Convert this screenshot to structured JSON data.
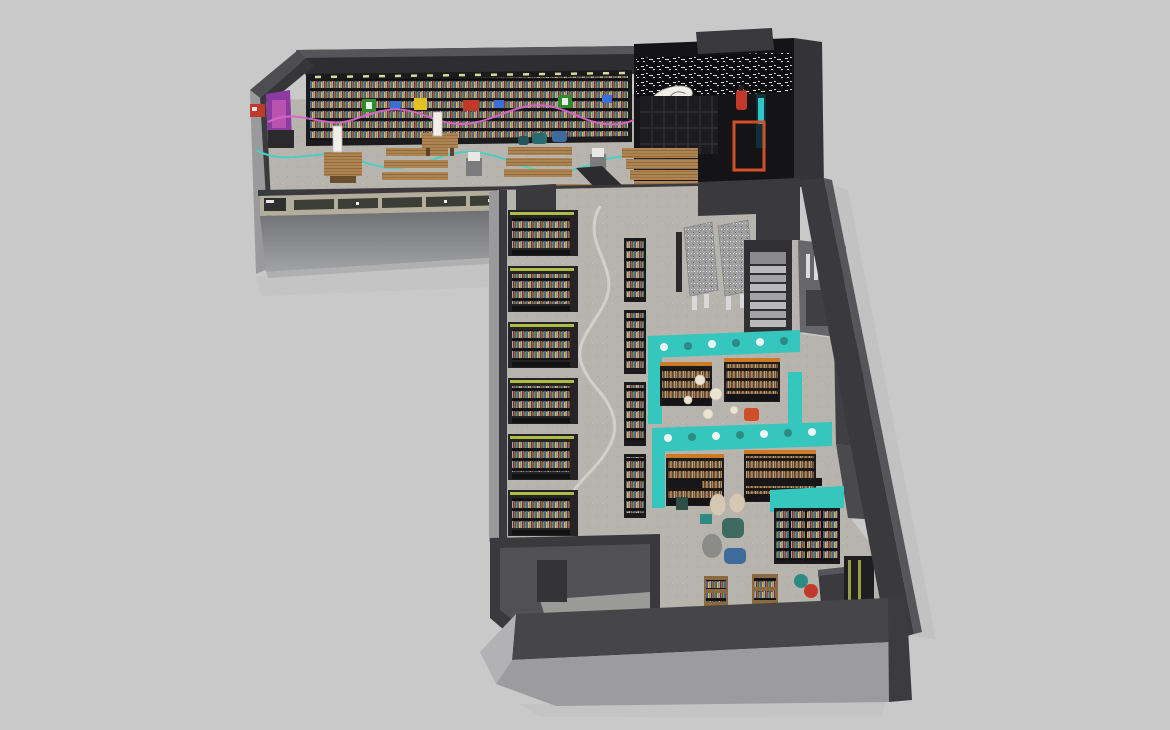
{
  "scene": {
    "description": "Isometric 3D render of an L-shaped bookstore interior floor plan on a plain gray background",
    "view": "top-down isometric render, no visible UI text",
    "rooms": [
      "entrance-hall-with-book-wall",
      "storefront-facade",
      "graffiti-event-corner",
      "shelf-aisle-gallery",
      "stairwell",
      "teal-reading-rooms",
      "beanbag-lounge",
      "back-room"
    ],
    "category_signs": [
      "green",
      "blue",
      "yellow",
      "red",
      "blue",
      "green",
      "blue"
    ],
    "path_lines": [
      "pink-wavy-line-on-book-wall",
      "teal-wavy-line-on-floor",
      "gray-wavy-line-on-aisle-floor"
    ]
  },
  "colors": {
    "background": "#c9c9c9",
    "wallTop": "#55555a",
    "wallFace": "#2e2e31",
    "wallDark": "#3a3a3e",
    "wallMid": "#4e4e52",
    "wallLight": "#9a9a9c",
    "black": "#101013",
    "shelfFrame": "#1b1b1d",
    "shelfBody": "#242427",
    "floor": "#b7b4ae",
    "backroomFloor": "#505055",
    "facadeTop": "#6f7073",
    "facadeBottom": "#a2a3a5",
    "windowBar": "#b3ae9c",
    "windowPane": "#3c3d35",
    "teal": "#35c6bd",
    "tealDark": "#2e8b84",
    "tealGlow": "#35d4d8",
    "orange": "#cc7a26",
    "orangeRed": "#cf4f28",
    "red": "#c0392b",
    "green": "#2e8b2e",
    "yellow": "#e3c21f",
    "blue": "#3a6fd8",
    "purple": "#8a3aa0",
    "pink": "#d765c8",
    "tealLine": "#49cfc4",
    "pathGray": "#d6d3cc",
    "granite": "#a0a0a0",
    "wood": "#ad8452",
    "woodDark": "#8f6a3c",
    "cream": "#d6c9b4",
    "beanGray": "#8b8b87",
    "beanGreen": "#3d6b5f",
    "beanBlue": "#3f6b9c",
    "white": "#f2efe8",
    "lime": "#c8d84a",
    "bookColors": [
      "#b5575a",
      "#7fa05a",
      "#5a7fb5",
      "#d9b84e",
      "#c8cacc"
    ],
    "warmBookColors": [
      "#b08a5a",
      "#8a5a3a",
      "#c9a06a",
      "#5f4430",
      "#d8c8a8"
    ]
  }
}
